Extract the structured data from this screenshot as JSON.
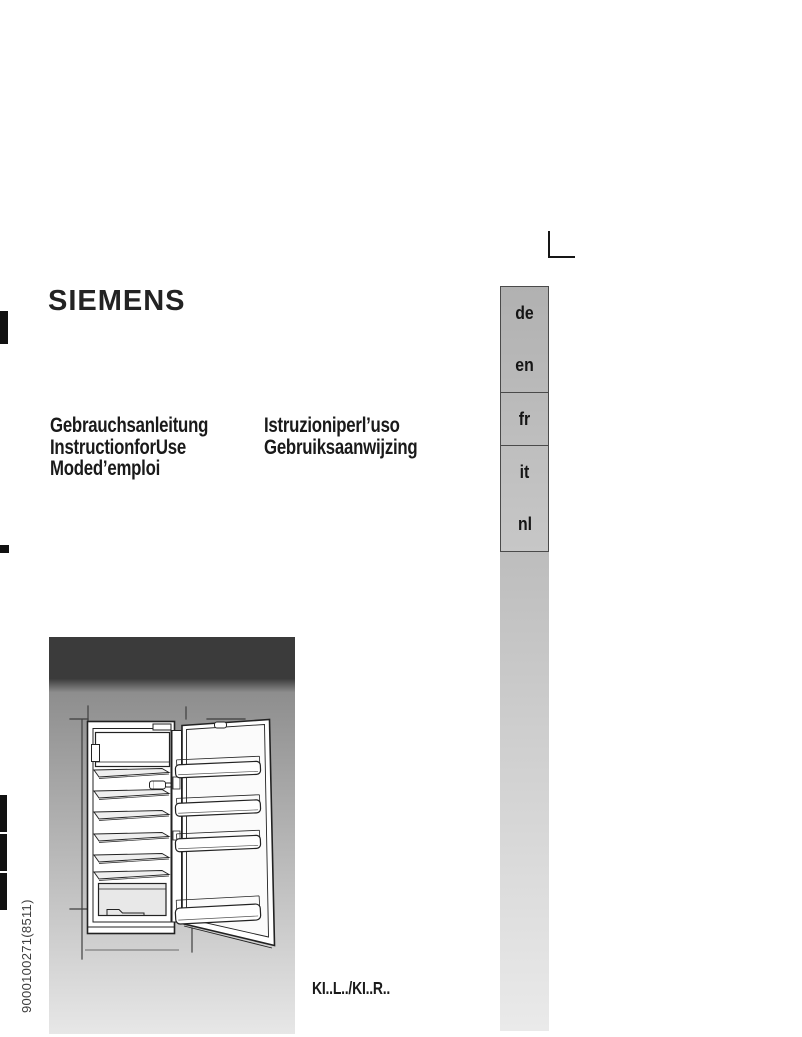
{
  "document": {
    "brand": "SIEMENS",
    "language_tabs": [
      "de",
      "en",
      "fr",
      "it",
      "nl"
    ],
    "titles_column_left": [
      "Gebrauchsanleitung",
      "InstructionforUse",
      "Moded’emploi"
    ],
    "titles_column_right": [
      "Istruzioniperl’uso",
      "Gebruiksaanwijzing"
    ],
    "model_reference": "KI..L../KI..R..",
    "order_number": "9000100271(8511)",
    "figure_description": "open-built-in-refrigerator-line-drawing"
  },
  "colors": {
    "text": "#1a1a1a",
    "tab_border": "#4a4a4a",
    "tab_fill_top": "#b1b1b1",
    "tab_fill_bottom": "#c7c7c7",
    "column_top": "#bdbdbd",
    "column_bottom": "#eaeaea",
    "figure_header": "#3b3b3b",
    "figure_bg_top": "#8e8e8e",
    "figure_bg_bottom": "#e7e7e7",
    "line_art": "#222222",
    "registration_mark": "#111111"
  }
}
